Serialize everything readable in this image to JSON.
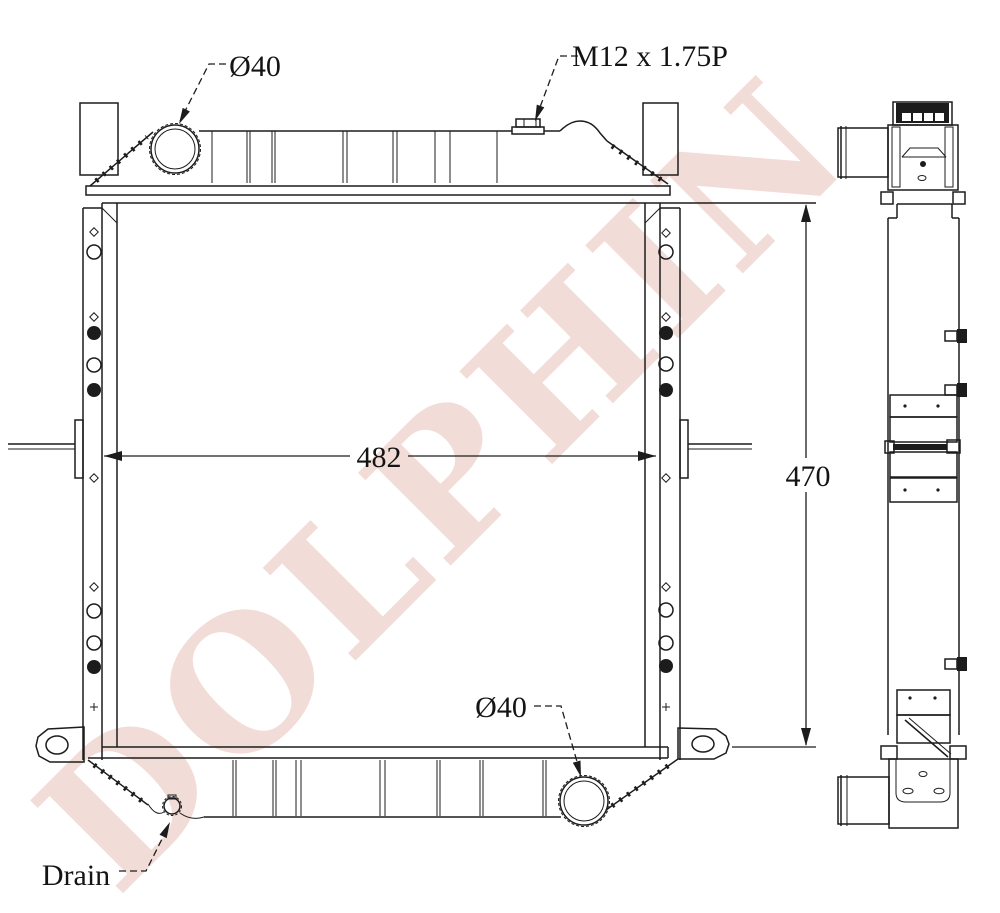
{
  "watermark": {
    "text": "DOLPHIN",
    "color": "#f2dcd7"
  },
  "labels": {
    "inlet_diameter": "Ø40",
    "filler_thread": "M12 x 1.75P",
    "outlet_diameter": "Ø40",
    "drain": "Drain"
  },
  "dimensions": {
    "core_width": "482",
    "core_height": "470"
  },
  "colors": {
    "line": "#1c1c1c",
    "background": "#ffffff"
  }
}
